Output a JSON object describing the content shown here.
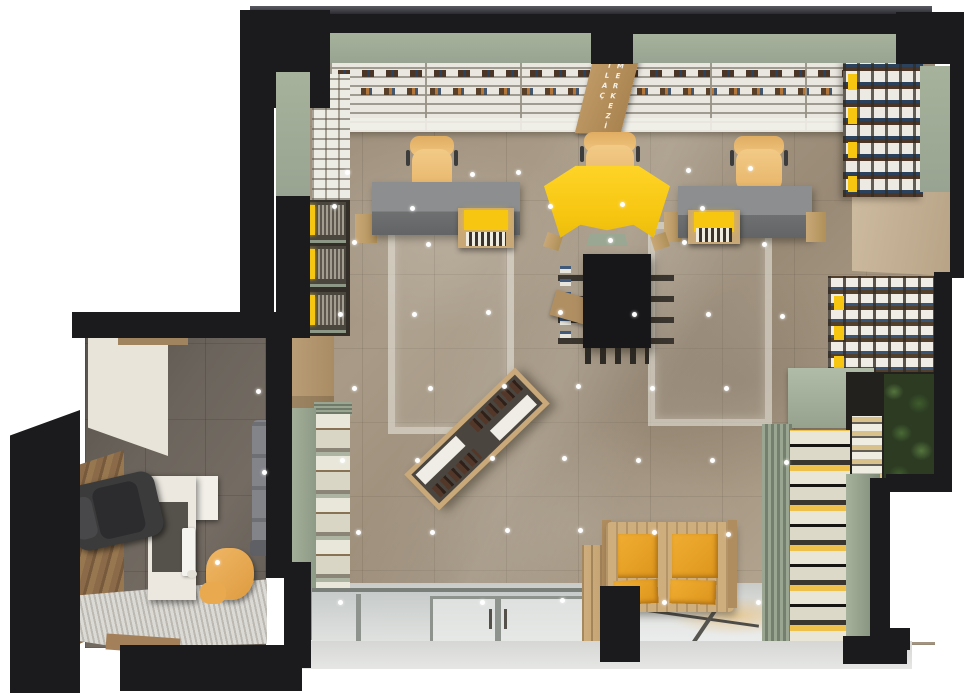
{
  "meta": {
    "title": "Pharmacy interior – top-down 3D floor plan render",
    "view": "top-down axonometric",
    "rooms": [
      {
        "id": "sales-area",
        "label": "Main retail / pharmacy sales area",
        "floor": "glossy beige marble tile"
      },
      {
        "id": "office",
        "label": "Consultation office with desk, monitor and chairs",
        "floor": "dark taupe tile"
      }
    ]
  },
  "sign": {
    "line1": "İLAÇ",
    "line2": "MERKEZİ"
  },
  "palette": {
    "wall": "#1b1b1d",
    "sage": "#a7b29c",
    "sage-dark": "#7d8a76",
    "floor": "#a29380",
    "floor-office": "#6b645c",
    "accent-yellow": "#f6c611",
    "cushion-orange": "#e8a22e",
    "chair-yellow": "#efc27e",
    "wood": "#c9a878",
    "wood-dark": "#8a6747",
    "desk-gray": "#8c8e8f",
    "shelf-white": "#eceae2",
    "gloss": "#d6d8d7",
    "plant-green": "#4a6a35"
  },
  "furniture": [
    {
      "id": "reception-counter",
      "label": "Yellow chevron reception counter",
      "color": "#f6c611"
    },
    {
      "id": "desk-left",
      "label": "Gray staff desk with cash register and yellow task chair"
    },
    {
      "id": "desk-right",
      "label": "Gray staff desk with cash register and yellow task chair"
    },
    {
      "id": "center-gondola",
      "label": "Black central display gondola with side fins"
    },
    {
      "id": "diagonal-showcase",
      "label": "Angled product showcase with bottle rows"
    },
    {
      "id": "waiting-bench",
      "label": "Wooden bench with two orange cushions"
    },
    {
      "id": "wall-shelving",
      "label": "Perimeter shelving stocked with medicine bottles and yellow boxes"
    },
    {
      "id": "plant-wall",
      "label": "Green plant wall in south-east corner"
    },
    {
      "id": "office-desk",
      "label": "White office desk with monitor"
    },
    {
      "id": "exec-chair",
      "label": "Dark executive chair"
    },
    {
      "id": "office-guest-chair",
      "label": "Yellow guest chair"
    },
    {
      "id": "office-sofa",
      "label": "Gray sofa"
    },
    {
      "id": "entrance-doors",
      "label": "Glass storefront entrance doors"
    }
  ],
  "floor_dots": [
    [
      345,
      170
    ],
    [
      470,
      172
    ],
    [
      516,
      170
    ],
    [
      686,
      168
    ],
    [
      748,
      166
    ],
    [
      332,
      204
    ],
    [
      410,
      206
    ],
    [
      548,
      204
    ],
    [
      620,
      202
    ],
    [
      700,
      206
    ],
    [
      352,
      240
    ],
    [
      426,
      242
    ],
    [
      608,
      238
    ],
    [
      682,
      240
    ],
    [
      762,
      242
    ],
    [
      338,
      312
    ],
    [
      412,
      312
    ],
    [
      486,
      310
    ],
    [
      558,
      310
    ],
    [
      632,
      312
    ],
    [
      706,
      312
    ],
    [
      780,
      314
    ],
    [
      352,
      386
    ],
    [
      428,
      386
    ],
    [
      502,
      384
    ],
    [
      576,
      384
    ],
    [
      650,
      386
    ],
    [
      724,
      386
    ],
    [
      340,
      458
    ],
    [
      415,
      458
    ],
    [
      490,
      456
    ],
    [
      562,
      456
    ],
    [
      636,
      458
    ],
    [
      710,
      458
    ],
    [
      784,
      460
    ],
    [
      356,
      530
    ],
    [
      430,
      530
    ],
    [
      505,
      528
    ],
    [
      578,
      528
    ],
    [
      652,
      530
    ],
    [
      726,
      532
    ],
    [
      338,
      600
    ],
    [
      480,
      600
    ],
    [
      560,
      598
    ],
    [
      662,
      600
    ],
    [
      756,
      600
    ],
    [
      256,
      389
    ],
    [
      262,
      470
    ],
    [
      215,
      560
    ]
  ]
}
